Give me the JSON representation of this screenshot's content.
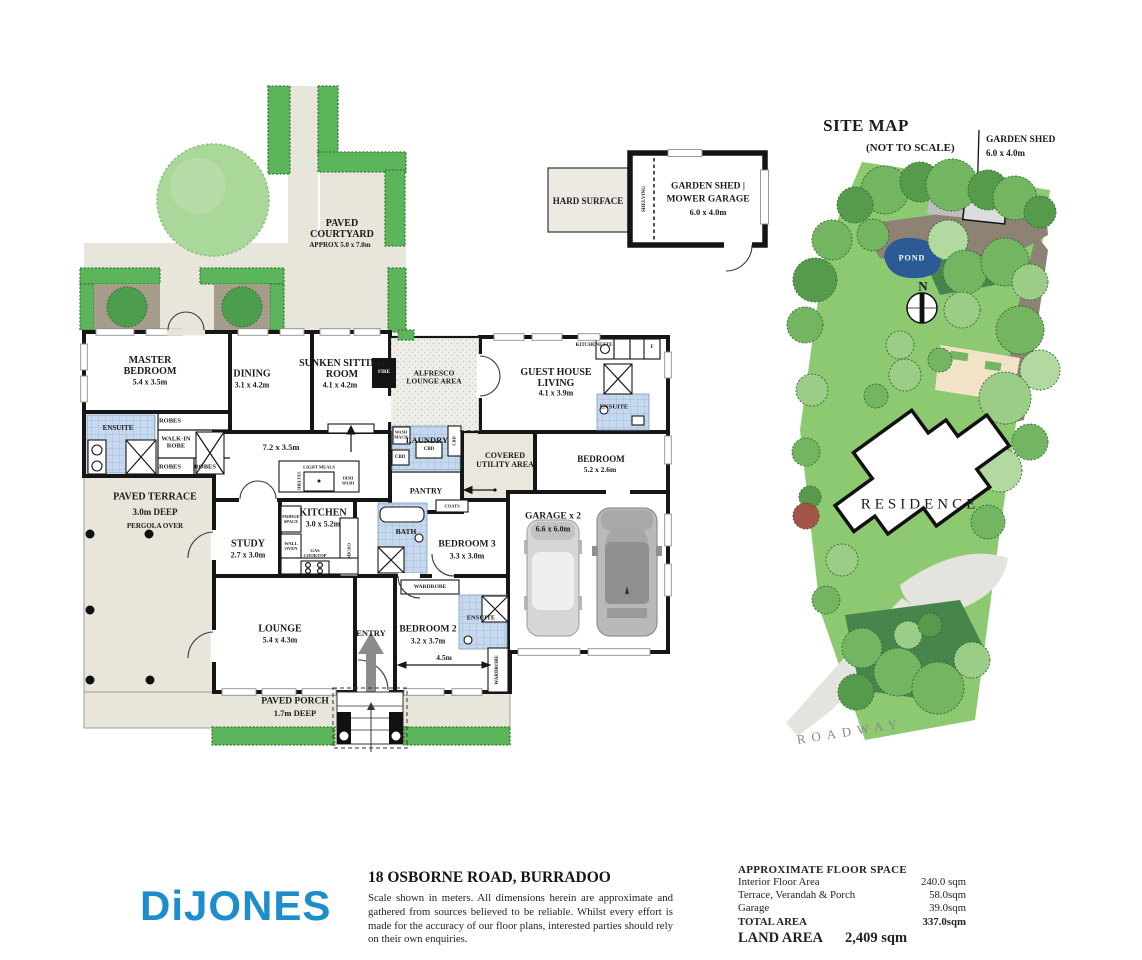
{
  "colors": {
    "brand_blue": "#1d8dce",
    "hedge_green": "#5cb55a",
    "site_green": "#8cc971",
    "pond_blue": "#2c5a94",
    "paving_beige": "#e8e5da",
    "tile_blue": "#c6d8ee",
    "wall_black": "#161616"
  },
  "floor_plan": {
    "courtyard": {
      "name": "PAVED COURTYARD",
      "approx": "APPROX  5.0 x 7.0m"
    },
    "rooms": {
      "master": {
        "name": "MASTER BEDROOM",
        "dims": "5.4 x 3.5m"
      },
      "dining": {
        "name": "DINING",
        "dims": "3.1 x 4.2m"
      },
      "sitting": {
        "name": "SUNKEN SITTING ROOM",
        "dims": "4.1 x 4.2m"
      },
      "alfresco": {
        "name": "ALFRESCO LOUNGE AREA"
      },
      "guest_living": {
        "name": "GUEST HOUSE LIVING",
        "dims": "4.1 x 3.9m"
      },
      "guest_bedroom": {
        "name": "BEDROOM",
        "dims": "5.2 x 2.6m"
      },
      "kitchen": {
        "name": "KITCHEN",
        "dims": "3.0 x 5.2m"
      },
      "study": {
        "name": "STUDY",
        "dims": "2.7 x 3.0m"
      },
      "lounge": {
        "name": "LOUNGE",
        "dims": "5.4 x 4.3m"
      },
      "entry": {
        "name": "ENTRY"
      },
      "bedroom2": {
        "name": "BEDROOM 2",
        "dims": "3.2 x 3.7m"
      },
      "bedroom3": {
        "name": "BEDROOM 3",
        "dims": "3.3 x 3.0m"
      },
      "garage": {
        "name": "GARAGE x 2",
        "dims": "6.6 x 6.0m"
      }
    },
    "areas": {
      "open_dims": "7.2 x 3.5m",
      "utility": {
        "name": "COVERED UTILITY AREA"
      },
      "laundry": "LAUNDRY",
      "pantry": "PANTRY",
      "terrace": {
        "name": "PAVED TERRACE",
        "deep": "3.0m DEEP",
        "pergola": "PERGOLA OVER"
      },
      "porch": {
        "name": "PAVED PORCH",
        "deep": "1.7m DEEP"
      }
    },
    "fixtures": {
      "ensuite": "ENSUITE",
      "robes": "ROBES",
      "walk_in_robe": "WALK-IN ROBE",
      "bath": "BATH",
      "wardrobe": "WARDROBE",
      "coats": "COATS",
      "fire": "FIRE",
      "kitchenette": "KITCHENETTE",
      "fridge": "F",
      "wash_mach": "WASH MACH",
      "cbd": "CBD",
      "light_meals": "LIGHT MEALS",
      "dish_wash": "DISH WASH",
      "shelves": "SHELVES",
      "fridge_space": "FRIDGE SPACE",
      "wall_oven": "WALL OVEN",
      "gas_cooktop": "GAS COOKTOP",
      "micro": "MICRO",
      "dim_bedroom2": "4.5m"
    }
  },
  "shed_plan": {
    "hard_surface": "HARD SURFACE",
    "shelving": "SHELVING",
    "title": "GARDEN SHED |",
    "line2": "MOWER GARAGE",
    "dims": "6.0 x 4.0m"
  },
  "site_map": {
    "title": "SITE MAP",
    "subtitle": "(NOT TO SCALE)",
    "shed_label": "GARDEN SHED",
    "shed_dims": "6.0 x 4.0m",
    "pond": "POND",
    "north": "N",
    "residence": "RESIDENCE",
    "roadway": "ROADWAY"
  },
  "footer": {
    "brand": "DiJONES",
    "address": "18 OSBORNE ROAD, BURRADOO",
    "disclaimer": "Scale shown in meters. All dimensions herein are approximate and gathered from sources believed to be reliable. Whilst every effort is made for the accuracy of our floor plans, interested parties should rely on their own enquiries.",
    "floor_space": {
      "title": "APPROXIMATE FLOOR SPACE",
      "rows": [
        {
          "label": "Interior Floor Area",
          "value": "240.0 sqm"
        },
        {
          "label": "Terrace, Verandah & Porch",
          "value": "58.0sqm"
        },
        {
          "label": "Garage",
          "value": "39.0sqm"
        }
      ],
      "total_label": "TOTAL AREA",
      "total_value": "337.0sqm",
      "land_label": "LAND AREA",
      "land_value": "2,409 sqm"
    }
  }
}
